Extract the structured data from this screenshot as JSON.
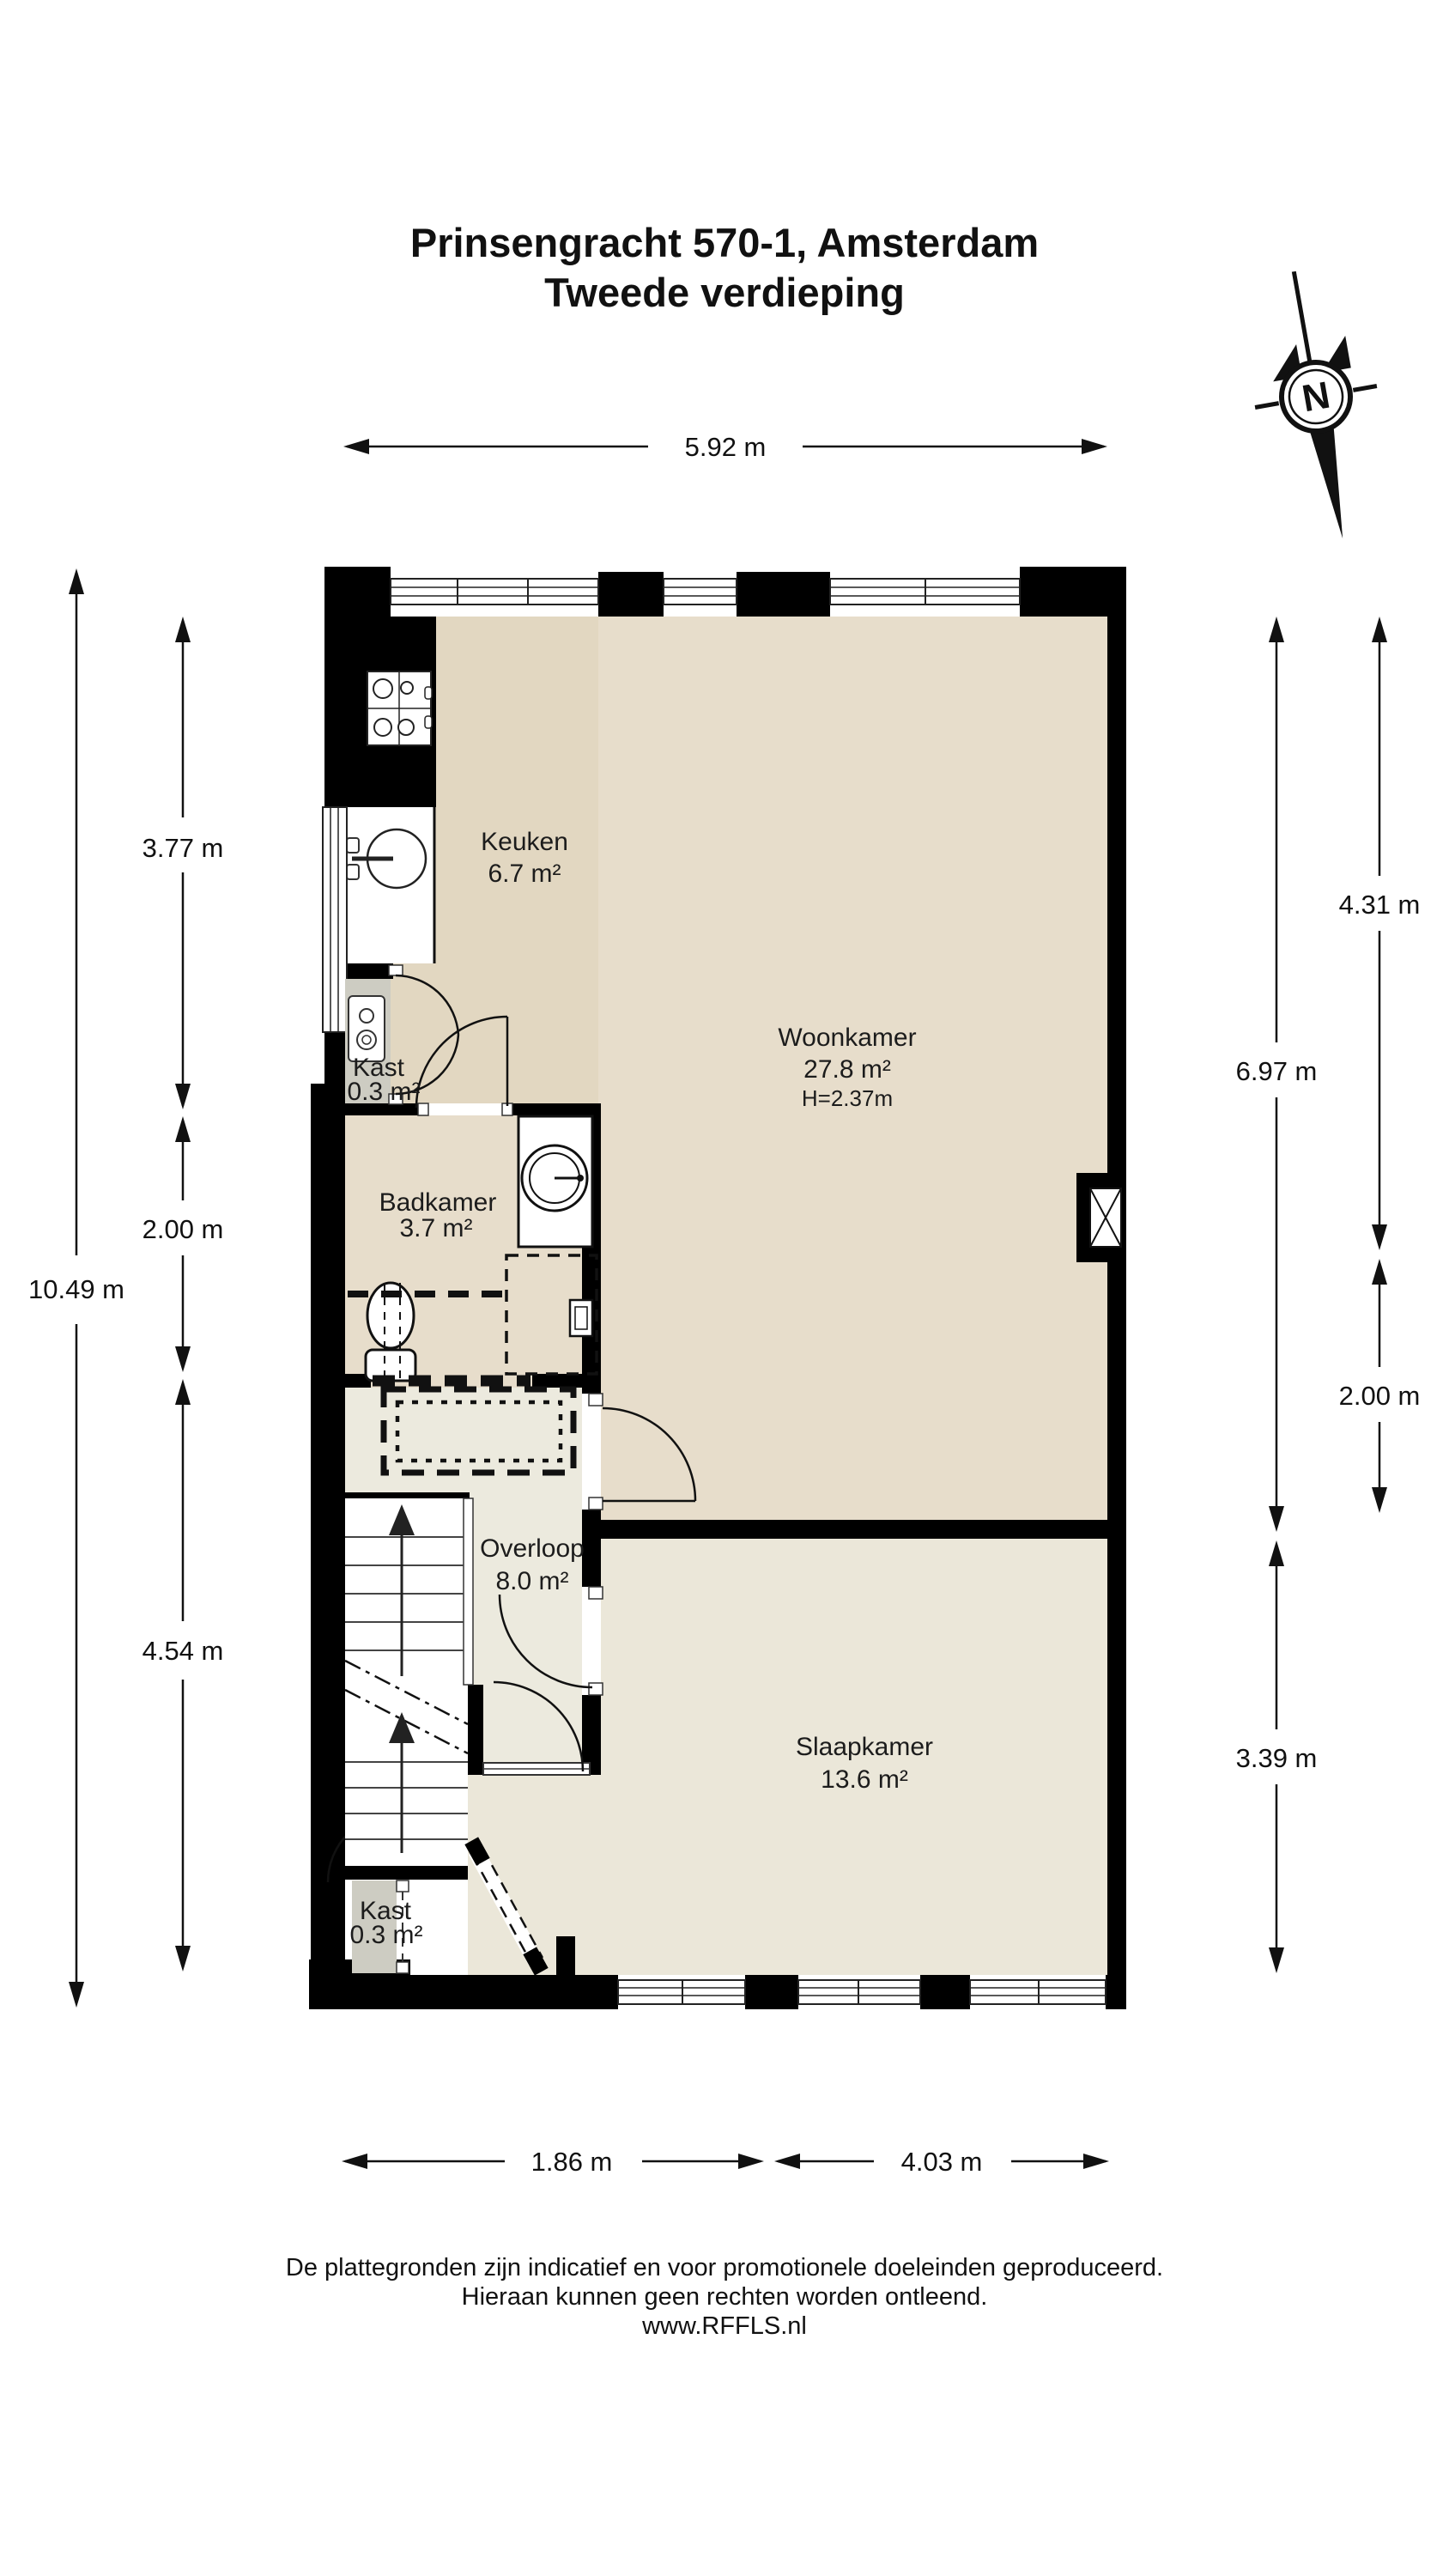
{
  "title": {
    "line1": "Prinsengracht 570-1, Amsterdam",
    "line2": "Tweede verdieping"
  },
  "compass": {
    "label": "N"
  },
  "floorplan": {
    "rooms": {
      "keuken": {
        "name": "Keuken",
        "area": "6.7 m²"
      },
      "woonkamer": {
        "name": "Woonkamer",
        "area": "27.8 m²",
        "ceiling_height": "H=2.37m"
      },
      "kast_boven": {
        "name": "Kast",
        "area": "0.3 m²"
      },
      "badkamer": {
        "name": "Badkamer",
        "area": "3.7 m²"
      },
      "overloop": {
        "name": "Overloop",
        "area": "8.0 m²"
      },
      "slaapkamer": {
        "name": "Slaapkamer",
        "area": "13.6 m²"
      },
      "kast_beneden": {
        "name": "Kast",
        "area": "0.3 m²"
      }
    },
    "dimensions": {
      "top_width": "5.92 m",
      "left_total": "10.49 m",
      "left_upper": "3.77 m",
      "left_middle": "2.00 m",
      "left_lower": "4.54 m",
      "right_outer_upper": "4.31 m",
      "right_outer_lower": "2.00 m",
      "right_inner_upper": "6.97 m",
      "right_inner_lower": "3.39 m",
      "bottom_left": "1.86 m",
      "bottom_right": "4.03 m"
    },
    "colors": {
      "wall": "#000000",
      "floor_living": "#e7ddcb",
      "floor_kitchen": "#e2d7c1",
      "floor_landing": "#eceade",
      "floor_bedroom": "#ebe7d9",
      "closet": "#cdccc2",
      "line": "#111111"
    }
  },
  "footer": {
    "line1": "De plattegronden zijn indicatief en voor promotionele doeleinden geproduceerd.",
    "line2": "Hieraan kunnen geen rechten worden ontleend.",
    "line3": "www.RFFLS.nl"
  }
}
